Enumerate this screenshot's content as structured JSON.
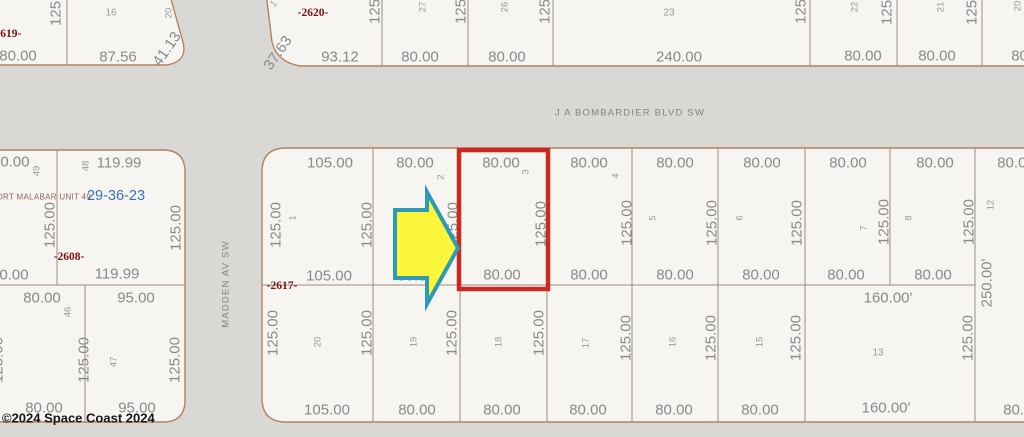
{
  "map": {
    "streets": {
      "horizontal": "J A BOMBARDIER BLVD SW",
      "vertical": "MADDEN AV SW"
    },
    "plat_name": "PORT MALABAR UNIT 49",
    "section_township_range": "29-36-23",
    "copyright": "©2024 Space Coast  2024",
    "parcel_ids": [
      "-2619-",
      "-2620-",
      "-2608-",
      "-2617-"
    ],
    "selected_parcel": {
      "lot": "3",
      "frontage": "80.00",
      "depth": "125.00"
    },
    "colors": {
      "background": "#d9d8d4",
      "parcel_fill": "#f6f5f2",
      "block_border": "#b2835e",
      "lot_line": "#9d8b7c",
      "dim_text": "#8a8a8a",
      "lot_text": "#9a9a9a",
      "parcel_id_text": "#7a1014",
      "section_text": "#3b72ad",
      "plat_text": "#8f6454",
      "highlight_red": "#c9291e",
      "arrow_fill": "#fbf53b",
      "arrow_stroke": "#2e9ab4"
    },
    "blocks": [
      {
        "d": "M -40 -40 L 160 -40 L 183 42 Q 188 62 166 65 L -40 65 Z"
      },
      {
        "d": "M 262 -40 L 272 42 Q 277 62 300 66 L 1070 66 L 1070 -40 Z"
      },
      {
        "d": "M -40 150 L 163 150 Q 185 150 185 172 L 185 400 Q 185 422 163 422 L -40 422 Z"
      },
      {
        "d": "M 286 148 L 1070 148 L 1070 422 L 286 422 Q 262 422 262 398 L 262 172 Q 262 148 286 148 Z"
      }
    ],
    "lot_lines": [
      [
        67,
        -40,
        67,
        65
      ],
      [
        382,
        -40,
        382,
        66
      ],
      [
        468,
        -40,
        468,
        66
      ],
      [
        553,
        -40,
        553,
        66
      ],
      [
        810,
        -40,
        810,
        66
      ],
      [
        897,
        -40,
        897,
        66
      ],
      [
        982,
        -40,
        982,
        66
      ],
      [
        -40,
        285,
        185,
        285
      ],
      [
        57,
        150,
        57,
        285
      ],
      [
        85,
        285,
        85,
        422
      ],
      [
        262,
        285,
        975,
        285
      ],
      [
        373,
        148,
        373,
        285
      ],
      [
        460,
        148,
        460,
        285
      ],
      [
        547,
        148,
        547,
        285
      ],
      [
        632,
        148,
        632,
        285
      ],
      [
        718,
        148,
        718,
        285
      ],
      [
        805,
        148,
        805,
        285
      ],
      [
        890,
        148,
        890,
        285
      ],
      [
        975,
        148,
        975,
        422
      ],
      [
        373,
        285,
        373,
        422
      ],
      [
        460,
        285,
        460,
        422
      ],
      [
        547,
        285,
        547,
        422
      ],
      [
        632,
        285,
        632,
        422
      ],
      [
        718,
        285,
        718,
        422
      ],
      [
        805,
        285,
        805,
        422
      ]
    ],
    "highlight": {
      "x": 459,
      "y": 150,
      "w": 89,
      "h": 139,
      "stroke_width": 4.5
    },
    "arrow": {
      "points": "395,210 427,210 427,192 458,248 427,304 427,278 395,278",
      "stroke_width": 4
    },
    "labels": [
      {
        "t": "125.00",
        "x": 56,
        "y": 3,
        "r": -90,
        "k": "dim"
      },
      {
        "t": "16",
        "x": 111,
        "y": 13,
        "k": "lot",
        "s": 10
      },
      {
        "t": "20",
        "x": 169,
        "y": 13,
        "r": -90,
        "k": "lot"
      },
      {
        "t": "-2619-",
        "x": 6,
        "y": 34,
        "k": "pid"
      },
      {
        "t": "80.00",
        "x": 18,
        "y": 56,
        "k": "dim"
      },
      {
        "t": "87.56",
        "x": 118,
        "y": 57,
        "k": "dim"
      },
      {
        "t": "41.13",
        "x": 167,
        "y": 49,
        "r": -55,
        "k": "dim"
      },
      {
        "t": "1",
        "x": 274,
        "y": 4,
        "r": -50,
        "k": "lot"
      },
      {
        "t": "-2620-",
        "x": 313,
        "y": 13,
        "k": "pid"
      },
      {
        "t": "37.63",
        "x": 278,
        "y": 53,
        "r": -55,
        "k": "dim"
      },
      {
        "t": "93.12",
        "x": 340,
        "y": 57,
        "k": "dim"
      },
      {
        "t": "125.00",
        "x": 375,
        "y": 1,
        "r": -90,
        "k": "dim"
      },
      {
        "t": "27",
        "x": 423,
        "y": 7,
        "r": -90,
        "k": "lot"
      },
      {
        "t": "80.00",
        "x": 420,
        "y": 57,
        "k": "dim"
      },
      {
        "t": "125.00",
        "x": 461,
        "y": 1,
        "r": -90,
        "k": "dim"
      },
      {
        "t": "26",
        "x": 505,
        "y": 7,
        "r": -90,
        "k": "lot"
      },
      {
        "t": "80.00",
        "x": 507,
        "y": 57,
        "k": "dim"
      },
      {
        "t": "125.00",
        "x": 545,
        "y": 1,
        "r": -90,
        "k": "dim"
      },
      {
        "t": "23",
        "x": 669,
        "y": 13,
        "k": "lot",
        "s": 10
      },
      {
        "t": "240.00",
        "x": 679,
        "y": 57,
        "k": "dim"
      },
      {
        "t": "125.00",
        "x": 801,
        "y": 1,
        "r": -90,
        "k": "dim"
      },
      {
        "t": "22",
        "x": 855,
        "y": 7,
        "r": -90,
        "k": "lot"
      },
      {
        "t": "80.00",
        "x": 863,
        "y": 56,
        "k": "dim"
      },
      {
        "t": "125.00",
        "x": 887,
        "y": 2,
        "r": -90,
        "k": "dim"
      },
      {
        "t": "21",
        "x": 941,
        "y": 7,
        "r": -90,
        "k": "lot"
      },
      {
        "t": "80.00",
        "x": 937,
        "y": 56,
        "k": "dim"
      },
      {
        "t": "125.00",
        "x": 972,
        "y": 2,
        "r": -90,
        "k": "dim"
      },
      {
        "t": "20",
        "x": 1018,
        "y": 6,
        "r": -90,
        "k": "lot"
      },
      {
        "t": "80.00",
        "x": 1030,
        "y": 56,
        "k": "dim"
      },
      {
        "t": "J A BOMBARDIER BLVD SW",
        "x": 630,
        "y": 113,
        "k": "street"
      },
      {
        "t": "MADDEN AV SW",
        "x": 226,
        "y": 284,
        "r": -90,
        "k": "street"
      },
      {
        "t": "0.00",
        "x": 15,
        "y": 162,
        "k": "dim"
      },
      {
        "t": "49",
        "x": 37,
        "y": 171,
        "r": -90,
        "k": "lot"
      },
      {
        "t": "48",
        "x": 86,
        "y": 166,
        "r": -90,
        "k": "lot"
      },
      {
        "t": "119.99",
        "x": 119,
        "y": 163,
        "k": "dim"
      },
      {
        "t": "PORT MALABAR UNIT 49",
        "x": 41,
        "y": 197,
        "k": "plat"
      },
      {
        "t": "29-36-23",
        "x": 116,
        "y": 196,
        "k": "sec"
      },
      {
        "t": "125.00",
        "x": 50,
        "y": 225,
        "r": -90,
        "k": "dim"
      },
      {
        "t": "125.00",
        "x": 176,
        "y": 228,
        "r": -90,
        "k": "dim"
      },
      {
        "t": "-2608-",
        "x": 69,
        "y": 257,
        "k": "pid"
      },
      {
        "t": "0.00",
        "x": 14,
        "y": 275,
        "k": "dim"
      },
      {
        "t": "119.99",
        "x": 117,
        "y": 274,
        "k": "dim"
      },
      {
        "t": "80.00",
        "x": 42,
        "y": 298,
        "k": "dim"
      },
      {
        "t": "95.00",
        "x": 136,
        "y": 298,
        "k": "dim"
      },
      {
        "t": "46",
        "x": 68,
        "y": 312,
        "r": -90,
        "k": "lot"
      },
      {
        "t": "47",
        "x": 114,
        "y": 362,
        "r": -90,
        "k": "lot"
      },
      {
        "t": "125.00",
        "x": -2,
        "y": 360,
        "r": -90,
        "k": "dim"
      },
      {
        "t": "125.00",
        "x": 84,
        "y": 360,
        "r": -90,
        "k": "dim"
      },
      {
        "t": "125.00",
        "x": 175,
        "y": 360,
        "r": -90,
        "k": "dim"
      },
      {
        "t": "80.00",
        "x": 44,
        "y": 408,
        "k": "dim"
      },
      {
        "t": "95.00",
        "x": 137,
        "y": 408,
        "k": "dim"
      },
      {
        "t": "105.00",
        "x": 330,
        "y": 163,
        "k": "dim"
      },
      {
        "t": "80.00",
        "x": 415,
        "y": 163,
        "k": "dim"
      },
      {
        "t": "80.00",
        "x": 501,
        "y": 163,
        "k": "dim"
      },
      {
        "t": "80.00",
        "x": 589,
        "y": 163,
        "k": "dim"
      },
      {
        "t": "80.00",
        "x": 675,
        "y": 163,
        "k": "dim"
      },
      {
        "t": "80.00",
        "x": 762,
        "y": 163,
        "k": "dim"
      },
      {
        "t": "80.00",
        "x": 848,
        "y": 163,
        "k": "dim"
      },
      {
        "t": "80.00",
        "x": 935,
        "y": 163,
        "k": "dim"
      },
      {
        "t": "80.00",
        "x": 1016,
        "y": 163,
        "k": "dim"
      },
      {
        "t": "1",
        "x": 293,
        "y": 218,
        "r": -90,
        "k": "lot"
      },
      {
        "t": "2",
        "x": 441,
        "y": 177,
        "r": -90,
        "k": "lot"
      },
      {
        "t": "3",
        "x": 526,
        "y": 172,
        "r": -90,
        "k": "lot"
      },
      {
        "t": "4",
        "x": 616,
        "y": 176,
        "r": -90,
        "k": "lot"
      },
      {
        "t": "5",
        "x": 653,
        "y": 218,
        "r": -90,
        "k": "lot"
      },
      {
        "t": "6",
        "x": 740,
        "y": 218,
        "r": -90,
        "k": "lot"
      },
      {
        "t": "7",
        "x": 864,
        "y": 228,
        "r": -90,
        "k": "lot"
      },
      {
        "t": "8",
        "x": 909,
        "y": 218,
        "r": -90,
        "k": "lot"
      },
      {
        "t": "12",
        "x": 991,
        "y": 205,
        "r": -90,
        "k": "lot"
      },
      {
        "t": "125.00",
        "x": 276,
        "y": 225,
        "r": -90,
        "k": "dim"
      },
      {
        "t": "125.00",
        "x": 367,
        "y": 225,
        "r": -90,
        "k": "dim"
      },
      {
        "t": "125.00",
        "x": 453,
        "y": 225,
        "r": -90,
        "k": "dim"
      },
      {
        "t": "125.00",
        "x": 541,
        "y": 224,
        "r": -90,
        "k": "dim"
      },
      {
        "t": "125.00",
        "x": 627,
        "y": 223,
        "r": -90,
        "k": "dim"
      },
      {
        "t": "125.00",
        "x": 712,
        "y": 223,
        "r": -90,
        "k": "dim"
      },
      {
        "t": "125.00",
        "x": 797,
        "y": 223,
        "r": -90,
        "k": "dim"
      },
      {
        "t": "125.00",
        "x": 884,
        "y": 222,
        "r": -90,
        "k": "dim"
      },
      {
        "t": "125.00",
        "x": 969,
        "y": 222,
        "r": -90,
        "k": "dim"
      },
      {
        "t": "250.00'",
        "x": 987,
        "y": 283,
        "r": -90,
        "k": "dim"
      },
      {
        "t": "-2617-",
        "x": 282,
        "y": 286,
        "k": "pid"
      },
      {
        "t": "105.00",
        "x": 329,
        "y": 276,
        "k": "dim"
      },
      {
        "t": "80.00",
        "x": 416,
        "y": 276,
        "k": "dim"
      },
      {
        "t": "80.00",
        "x": 502,
        "y": 275,
        "k": "dim"
      },
      {
        "t": "80.00",
        "x": 589,
        "y": 275,
        "k": "dim"
      },
      {
        "t": "80.00",
        "x": 675,
        "y": 275,
        "k": "dim"
      },
      {
        "t": "80.00",
        "x": 761,
        "y": 275,
        "k": "dim"
      },
      {
        "t": "80.00",
        "x": 846,
        "y": 275,
        "k": "dim"
      },
      {
        "t": "80.00",
        "x": 933,
        "y": 275,
        "k": "dim"
      },
      {
        "t": "160.00'",
        "x": 888,
        "y": 298,
        "k": "dim"
      },
      {
        "t": "20",
        "x": 318,
        "y": 342,
        "r": -90,
        "k": "lot"
      },
      {
        "t": "19",
        "x": 414,
        "y": 342,
        "r": -90,
        "k": "lot"
      },
      {
        "t": "18",
        "x": 499,
        "y": 342,
        "r": -90,
        "k": "lot"
      },
      {
        "t": "17",
        "x": 586,
        "y": 343,
        "r": -90,
        "k": "lot"
      },
      {
        "t": "16",
        "x": 673,
        "y": 342,
        "r": -90,
        "k": "lot"
      },
      {
        "t": "15",
        "x": 760,
        "y": 342,
        "r": -90,
        "k": "lot"
      },
      {
        "t": "13",
        "x": 878,
        "y": 353,
        "k": "lot",
        "s": 10
      },
      {
        "t": "125.00",
        "x": 273,
        "y": 333,
        "r": -90,
        "k": "dim"
      },
      {
        "t": "125.00",
        "x": 367,
        "y": 333,
        "r": -90,
        "k": "dim"
      },
      {
        "t": "125.00",
        "x": 452,
        "y": 333,
        "r": -90,
        "k": "dim"
      },
      {
        "t": "125.00",
        "x": 539,
        "y": 333,
        "r": -90,
        "k": "dim"
      },
      {
        "t": "125.00",
        "x": 626,
        "y": 338,
        "r": -90,
        "k": "dim"
      },
      {
        "t": "125.00",
        "x": 711,
        "y": 338,
        "r": -90,
        "k": "dim"
      },
      {
        "t": "125.00",
        "x": 796,
        "y": 338,
        "r": -90,
        "k": "dim"
      },
      {
        "t": "125.00",
        "x": 968,
        "y": 338,
        "r": -90,
        "k": "dim"
      },
      {
        "t": "105.00",
        "x": 327,
        "y": 410,
        "k": "dim"
      },
      {
        "t": "80.00",
        "x": 417,
        "y": 410,
        "k": "dim"
      },
      {
        "t": "80.00",
        "x": 502,
        "y": 410,
        "k": "dim"
      },
      {
        "t": "80.00",
        "x": 588,
        "y": 410,
        "k": "dim"
      },
      {
        "t": "80.00",
        "x": 674,
        "y": 410,
        "k": "dim"
      },
      {
        "t": "80.00",
        "x": 760,
        "y": 410,
        "k": "dim"
      },
      {
        "t": "160.00'",
        "x": 886,
        "y": 408,
        "k": "dim"
      },
      {
        "t": "80.00",
        "x": 1022,
        "y": 410,
        "k": "dim"
      },
      {
        "t": "©2024 Space Coast  2024",
        "x": 2,
        "y": 418,
        "k": "copy"
      }
    ]
  }
}
